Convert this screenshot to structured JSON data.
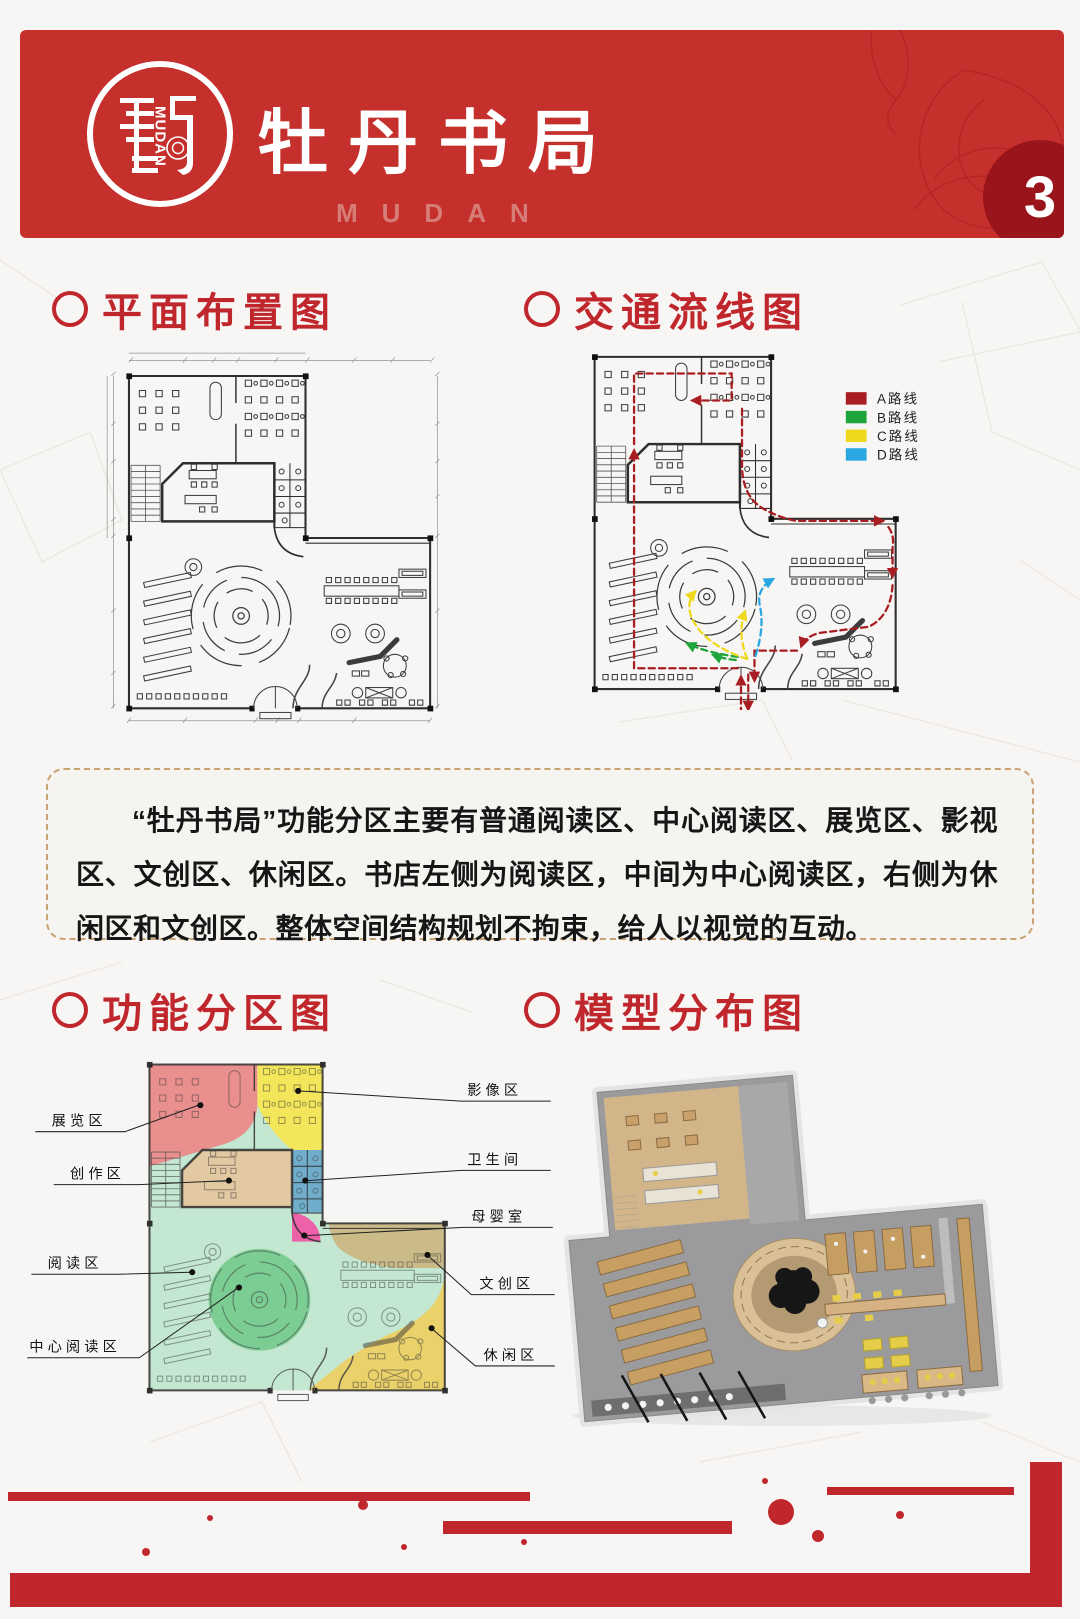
{
  "page": {
    "accent_red": "#C5302D",
    "title_red": "#C0272D",
    "dark_red": "#9A151B",
    "background": "#F7F6F4"
  },
  "header": {
    "logo_vertical_text": "MUDAN",
    "title": "牡丹书局",
    "subtitle": "MUDAN",
    "page_number": "3"
  },
  "sections": {
    "floor_plan": {
      "title": "平面布置图"
    },
    "traffic_flow": {
      "title": "交通流线图",
      "legend": [
        {
          "label": "A路线",
          "color": "#A81D22"
        },
        {
          "label": "B路线",
          "color": "#1EA53B"
        },
        {
          "label": "C路线",
          "color": "#EFD91F"
        },
        {
          "label": "D路线",
          "color": "#2AA7E0"
        }
      ]
    },
    "functional_zoning": {
      "title": "功能分区图",
      "zone_labels": [
        {
          "label": "展览区",
          "color": "#E98F8E"
        },
        {
          "label": "创作区",
          "color": "#E2C9A2"
        },
        {
          "label": "影像区",
          "color": "#F3E65A"
        },
        {
          "label": "卫生间",
          "color": "#6FADCA"
        },
        {
          "label": "母婴室",
          "color": "#EC61A8"
        },
        {
          "label": "阅读区",
          "color": "#C3E7D1"
        },
        {
          "label": "中心阅读区",
          "color": "#7CCD94"
        },
        {
          "label": "文创区",
          "color": "#CBBB89"
        },
        {
          "label": "休闲区",
          "color": "#EAD169"
        }
      ]
    },
    "model_distribution": {
      "title": "模型分布图"
    }
  },
  "description": {
    "text": "“牡丹书局”功能分区主要有普通阅读区、中心阅读区、展览区、影视区、文创区、休闲区。书店左侧为阅读区，中间为中心阅读区，右侧为休闲区和文创区。整体空间结构规划不拘束，给人以视觉的互动。"
  }
}
